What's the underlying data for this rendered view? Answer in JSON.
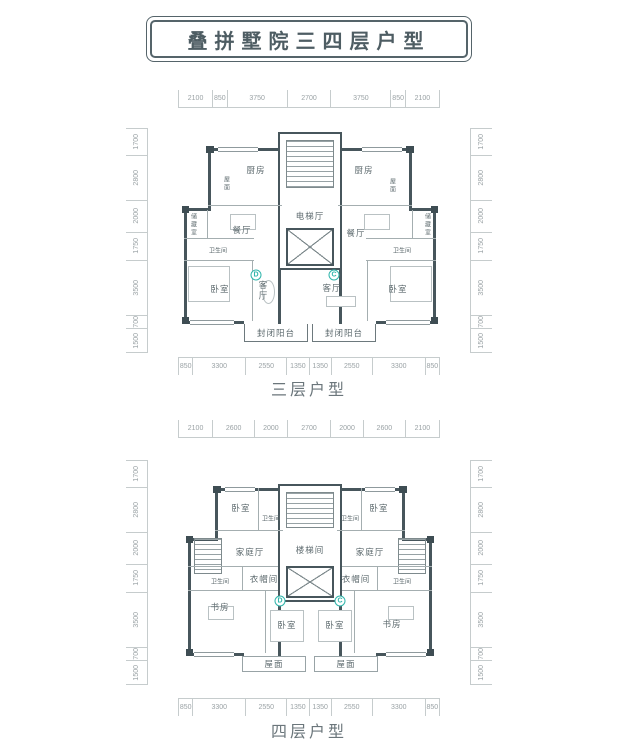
{
  "title": "叠拼墅院三四层户型",
  "colors": {
    "wall": "#47565c",
    "dim_text": "#9aa2a5",
    "accent_teal": "#2fb5ab",
    "title_text": "#4e5d63"
  },
  "plan3": {
    "caption": "三层户型",
    "dims_top": [
      "2100",
      "850",
      "3750",
      "2700",
      "3750",
      "850",
      "2100"
    ],
    "dims_bottom": [
      "850",
      "3300",
      "2550",
      "1350",
      "1350",
      "2550",
      "3300",
      "850"
    ],
    "dims_left": [
      "1700",
      "2800",
      "2000",
      "1750",
      "3500",
      "700",
      "1500"
    ],
    "dims_right": [
      "1700",
      "2800",
      "2000",
      "1750",
      "3500",
      "700",
      "1500"
    ],
    "rooms": {
      "kitchen_left": "厨房",
      "kitchen_right": "厨房",
      "roof_left": "屋面",
      "roof_right": "屋面",
      "dining_left": "餐厅",
      "dining_right": "餐厅",
      "storage_left": "储藏室",
      "storage_right": "储藏室",
      "bath_left": "卫生间",
      "bath_right": "卫生间",
      "bedroom_left": "卧室",
      "bedroom_right": "卧室",
      "living_left": "客厅",
      "living_right": "客厅",
      "balcony_left": "封闭阳台",
      "balcony_right": "封闭阳台",
      "elevator_hall": "电梯厅",
      "unit_left_mark": "D",
      "unit_right_mark": "C"
    }
  },
  "plan4": {
    "caption": "四层户型",
    "dims_top": [
      "2100",
      "2600",
      "2000",
      "2700",
      "2000",
      "2600",
      "2100"
    ],
    "dims_bottom": [
      "850",
      "3300",
      "2550",
      "1350",
      "1350",
      "2550",
      "3300",
      "850"
    ],
    "dims_left": [
      "1700",
      "2800",
      "2000",
      "1750",
      "3500",
      "700",
      "1500"
    ],
    "dims_right": [
      "1700",
      "2800",
      "2000",
      "1750",
      "3500",
      "700",
      "1500"
    ],
    "rooms": {
      "bedroom_tl": "卧室",
      "bedroom_tr": "卧室",
      "bath_tl": "卫生间",
      "bath_tr": "卫生间",
      "family_left": "家庭厅",
      "family_right": "家庭厅",
      "stairwell": "楼梯间",
      "cloak_left": "衣帽间",
      "cloak_right": "衣帽间",
      "bath_bl": "卫生间",
      "bath_br": "卫生间",
      "study_left": "书房",
      "study_right": "书房",
      "bedroom_bl": "卧室",
      "bedroom_br": "卧室",
      "roof_left": "屋面",
      "roof_right": "屋面",
      "unit_left_mark": "D",
      "unit_right_mark": "C"
    }
  }
}
